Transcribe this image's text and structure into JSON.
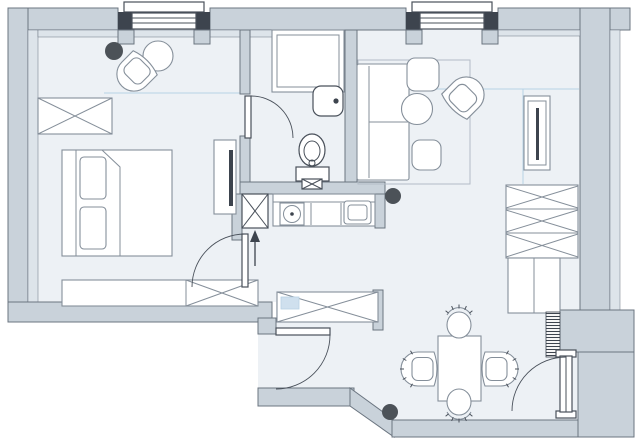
{
  "type": "floor-plan",
  "colors": {
    "bg": "#ffffff",
    "wall": "#c9d2da",
    "wall-light": "#dde4ea",
    "wall-stroke": "#6b7580",
    "floor": "#edf1f5",
    "furn-stroke": "#858f9a",
    "fix-stroke": "#49505a",
    "dark": "#3d444e",
    "dot": "#4c5258",
    "accent": "#b7d2e5",
    "accent-fill": "#cfe0ee",
    "rug-stroke": "#b3bcc6"
  },
  "inventory": {
    "structure": [
      "exterior-walls",
      "interior-partitions",
      "window",
      "window",
      "ventilation-shaft",
      "entry-alcove"
    ],
    "doors": [
      "bathroom-door",
      "bedroom-door",
      "hall-door",
      "entry-door"
    ],
    "bedroom": [
      "wardrobe",
      "plant-dot",
      "round-side-table",
      "armchair",
      "double-bed",
      "pillow",
      "pillow",
      "tv-stand",
      "tv",
      "low-dresser"
    ],
    "bathroom": [
      "shower",
      "washbasin",
      "toilet"
    ],
    "kitchenette": [
      "counter",
      "round-sink",
      "cooktop",
      "direction-arrow",
      "plant-dot"
    ],
    "living_room": [
      "rug",
      "sofa",
      "pouf",
      "pouf",
      "coffee-table",
      "armchair",
      "tv-console",
      "tv",
      "zigzag-wardrobe",
      "cabinet"
    ],
    "hallway": [
      "crossed-closet",
      "blue-box"
    ],
    "dining_area": [
      "dining-table",
      "dining-chair",
      "dining-chair",
      "dining-chair",
      "dining-chair",
      "plant-dot"
    ],
    "entry": [
      "coat-rack",
      "door-leaf"
    ]
  },
  "counts": {
    "windows": 2,
    "door-arcs": 4,
    "dark-dots": 3
  }
}
